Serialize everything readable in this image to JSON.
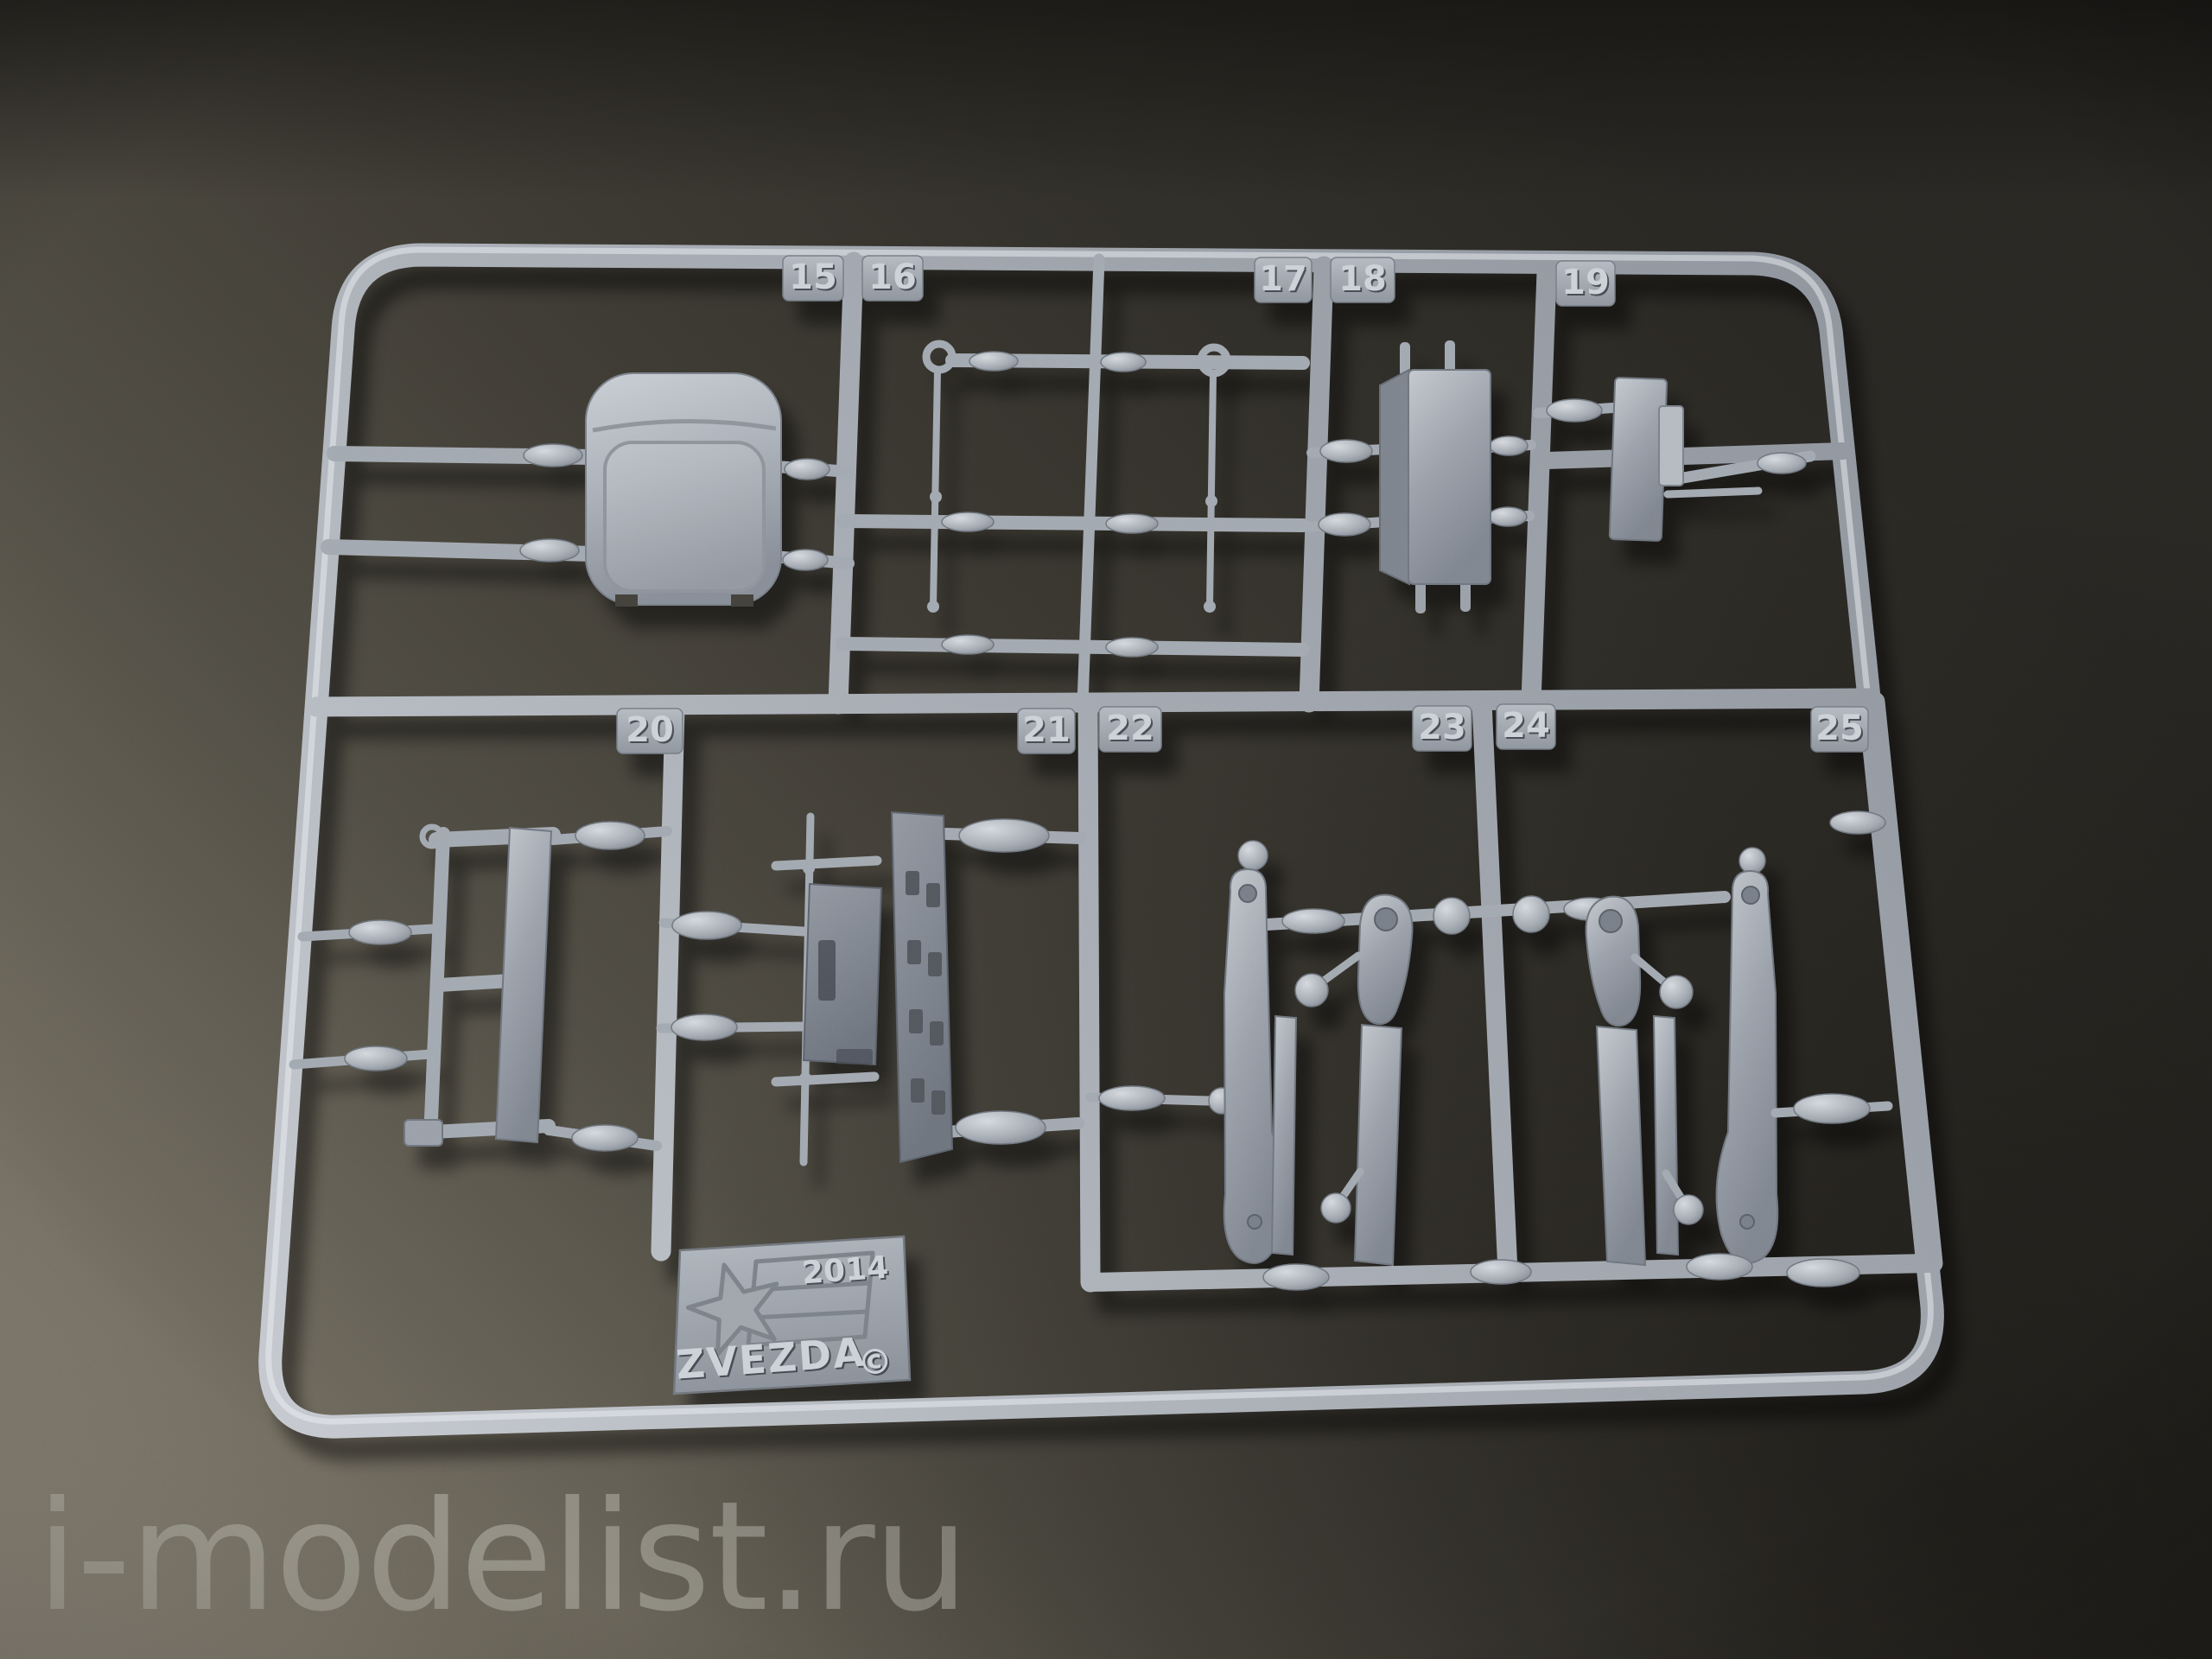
{
  "background": {
    "light": "#9d9687",
    "mid": "#4b4840",
    "dark": "#27241f"
  },
  "sprue": {
    "plastic_color": "#a8adb5",
    "plastic_highlight": "#d9dce1",
    "plastic_shadow": "#6d727a",
    "tabs_top": [
      "15",
      "16",
      "17",
      "18",
      "19"
    ],
    "tabs_bottom": [
      "20",
      "21",
      "22",
      "23",
      "24",
      "25"
    ],
    "logo": {
      "year": "2014",
      "brand": "ZVEZDA",
      "copyright": "©"
    }
  },
  "watermark": {
    "text": "i-modelist.ru"
  }
}
